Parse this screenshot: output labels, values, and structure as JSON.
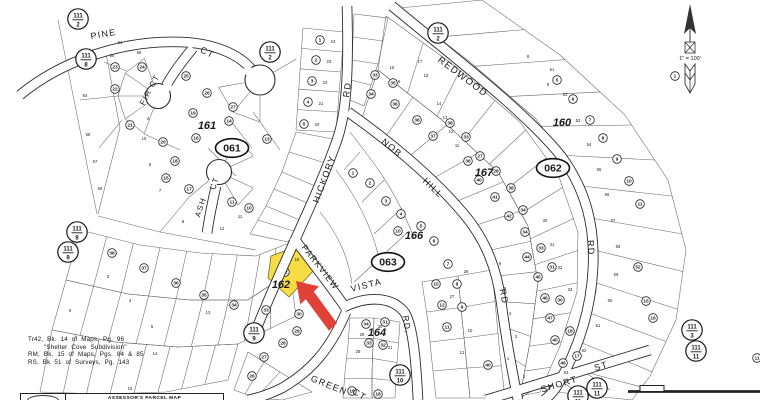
{
  "map": {
    "street_labels": [
      {
        "t": "PINE",
        "x": 104,
        "y": 37,
        "r": -10,
        "s": 9
      },
      {
        "t": "CT",
        "x": 206,
        "y": 55,
        "r": 28,
        "s": 9
      },
      {
        "t": "FIR CT",
        "x": 152,
        "y": 91,
        "r": -62,
        "s": 8
      },
      {
        "t": "ASH",
        "x": 203,
        "y": 208,
        "r": -72,
        "s": 8
      },
      {
        "t": "CT",
        "x": 217,
        "y": 184,
        "r": -72,
        "s": 8
      },
      {
        "t": "HICKORY",
        "x": 327,
        "y": 180,
        "r": -70,
        "s": 9
      },
      {
        "t": "RD",
        "x": 350,
        "y": 90,
        "r": -82,
        "s": 9
      },
      {
        "t": "NOB",
        "x": 390,
        "y": 150,
        "r": 40,
        "s": 9
      },
      {
        "t": "HILL",
        "x": 431,
        "y": 190,
        "r": 44,
        "s": 9
      },
      {
        "t": "RD",
        "x": 501,
        "y": 297,
        "r": 80,
        "s": 9
      },
      {
        "t": "REDWOOD",
        "x": 461,
        "y": 79,
        "r": 37,
        "s": 9.5
      },
      {
        "t": "RD",
        "x": 588,
        "y": 248,
        "r": 86,
        "s": 9
      },
      {
        "t": "PARKVIEW",
        "x": 318,
        "y": 269,
        "r": 52,
        "s": 8.5
      },
      {
        "t": "VISTA",
        "x": 367,
        "y": 288,
        "r": -14,
        "s": 9
      },
      {
        "t": "RD.",
        "x": 404,
        "y": 325,
        "r": 82,
        "s": 8.5
      },
      {
        "t": "GREEN",
        "x": 328,
        "y": 388,
        "r": 22,
        "s": 9
      },
      {
        "t": "CT",
        "x": 358,
        "y": 397,
        "r": 32,
        "s": 9
      },
      {
        "t": "SHORT",
        "x": 560,
        "y": 387,
        "r": -17,
        "s": 9
      },
      {
        "t": "ST",
        "x": 602,
        "y": 369,
        "r": -17,
        "s": 9
      }
    ],
    "block_labels": [
      {
        "t": "161",
        "x": 207,
        "y": 129
      },
      {
        "t": "160",
        "x": 562,
        "y": 126
      },
      {
        "t": "167",
        "x": 484,
        "y": 176
      },
      {
        "t": "166",
        "x": 414,
        "y": 239
      },
      {
        "t": "162",
        "x": 281,
        "y": 288
      },
      {
        "t": "164",
        "x": 377,
        "y": 336
      }
    ],
    "book_ovals": [
      {
        "t": "061",
        "x": 232,
        "y": 148
      },
      {
        "t": "062",
        "x": 553,
        "y": 168
      },
      {
        "t": "063",
        "x": 388,
        "y": 262
      }
    ],
    "ref_circles": [
      {
        "top": "111",
        "bottom": "2",
        "x": 78,
        "y": 19
      },
      {
        "top": "111",
        "bottom": "8",
        "x": 86,
        "y": 59
      },
      {
        "top": "111",
        "bottom": "2",
        "x": 270,
        "y": 52
      },
      {
        "top": "111",
        "bottom": "2",
        "x": 438,
        "y": 33
      },
      {
        "top": "111",
        "bottom": "8",
        "x": 77,
        "y": 232
      },
      {
        "top": "111",
        "bottom": "9",
        "x": 68,
        "y": 252
      },
      {
        "top": "111",
        "bottom": "9",
        "x": 254,
        "y": 333
      },
      {
        "top": "111",
        "bottom": "10",
        "x": 400,
        "y": 375
      },
      {
        "top": "111",
        "bottom": "11",
        "x": 597,
        "y": 388
      },
      {
        "top": "111",
        "bottom": "11",
        "x": 578,
        "y": 396
      },
      {
        "top": "111",
        "bottom": "3",
        "x": 692,
        "y": 330
      },
      {
        "top": "111",
        "bottom": "11",
        "x": 696,
        "y": 351
      }
    ],
    "parcel_circles": [
      [
        "23",
        115,
        67
      ],
      [
        "24",
        142,
        67
      ],
      [
        "22",
        115,
        89
      ],
      [
        "25",
        186,
        76
      ],
      [
        "26",
        207,
        93
      ],
      [
        "27",
        233,
        107
      ],
      [
        "21",
        130,
        125
      ],
      [
        "19",
        193,
        113
      ],
      [
        "14",
        229,
        121
      ],
      [
        "16",
        196,
        138
      ],
      [
        "13",
        267,
        139
      ],
      [
        "20",
        163,
        142
      ],
      [
        "18",
        175,
        161
      ],
      [
        "15",
        166,
        178
      ],
      [
        "17",
        189,
        189
      ],
      [
        "11",
        232,
        202
      ],
      [
        "10",
        249,
        208
      ],
      [
        "1",
        320,
        40
      ],
      [
        "2",
        316,
        60
      ],
      [
        "3",
        312,
        81
      ],
      [
        "4",
        308,
        102
      ],
      [
        "5",
        304,
        124
      ],
      [
        "1",
        353,
        173
      ],
      [
        "2",
        370,
        183
      ],
      [
        "3",
        386,
        201
      ],
      [
        "4",
        401,
        214
      ],
      [
        "5",
        421,
        226
      ],
      [
        "6",
        434,
        241
      ],
      [
        "7",
        448,
        264
      ],
      [
        "8",
        457,
        284
      ],
      [
        "9",
        462,
        307
      ],
      [
        "10",
        398,
        231
      ],
      [
        "33",
        375,
        75
      ],
      [
        "34",
        371,
        94
      ],
      [
        "35",
        393,
        83
      ],
      [
        "36",
        395,
        104
      ],
      [
        "36",
        417,
        120
      ],
      [
        "37",
        433,
        136
      ],
      [
        "38",
        450,
        123
      ],
      [
        "33",
        466,
        137
      ],
      [
        "27",
        480,
        156
      ],
      [
        "36",
        468,
        161
      ],
      [
        "28",
        496,
        171
      ],
      [
        "40",
        479,
        180
      ],
      [
        "38",
        511,
        188
      ],
      [
        "41",
        495,
        197
      ],
      [
        "42",
        509,
        216
      ],
      [
        "34",
        523,
        210
      ],
      [
        "34",
        525,
        232
      ],
      [
        "33",
        541,
        248
      ],
      [
        "44",
        527,
        257
      ],
      [
        "31",
        552,
        267
      ],
      [
        "45",
        538,
        277
      ],
      [
        "46",
        545,
        298
      ],
      [
        "30",
        560,
        300
      ],
      [
        "47",
        550,
        318
      ],
      [
        "18",
        570,
        331
      ],
      [
        "45",
        555,
        340
      ],
      [
        "17",
        577,
        356
      ],
      [
        "46",
        563,
        363
      ],
      [
        "52",
        638,
        267
      ],
      [
        "15",
        646,
        301
      ],
      [
        "16",
        653,
        318
      ],
      [
        "11",
        757,
        358
      ],
      [
        "40",
        488,
        365
      ],
      [
        "1",
        675,
        76
      ],
      [
        "5",
        557,
        80
      ],
      [
        "6",
        573,
        99
      ],
      [
        "7",
        590,
        120
      ],
      [
        "8",
        603,
        138
      ],
      [
        "9",
        617,
        159
      ],
      [
        "10",
        629,
        181
      ],
      [
        "11",
        640,
        204
      ],
      [
        "34",
        366,
        324
      ],
      [
        "31",
        385,
        322
      ],
      [
        "33",
        369,
        343
      ],
      [
        "32",
        383,
        345
      ],
      [
        "15",
        436,
        284
      ],
      [
        "12",
        442,
        305
      ],
      [
        "11",
        447,
        327
      ],
      [
        "33",
        266,
        310
      ],
      [
        "30",
        299,
        314
      ],
      [
        "29",
        297,
        331
      ],
      [
        "28",
        283,
        343
      ],
      [
        "27",
        264,
        357
      ],
      [
        "26",
        252,
        376
      ],
      [
        "38",
        112,
        253
      ],
      [
        "37",
        144,
        268
      ],
      [
        "36",
        176,
        283
      ],
      [
        "35",
        204,
        295
      ],
      [
        "34",
        234,
        305
      ],
      [
        "19",
        352,
        391
      ],
      [
        "18",
        378,
        394
      ]
    ],
    "lot_numbers": [
      [
        "24",
        333,
        43
      ],
      [
        "23",
        329,
        63
      ],
      [
        "22",
        325,
        84
      ],
      [
        "21",
        321,
        105
      ],
      [
        "20",
        317,
        126
      ],
      [
        "65",
        112,
        57
      ],
      [
        "66",
        139,
        54
      ],
      [
        "64",
        85,
        97
      ],
      [
        "61",
        120,
        44
      ],
      [
        "57",
        95,
        163
      ],
      [
        "58",
        88,
        136
      ],
      [
        "56",
        100,
        190
      ],
      [
        "17",
        420,
        63
      ],
      [
        "18",
        426,
        77
      ],
      [
        "15",
        392,
        69
      ],
      [
        "16",
        398,
        83
      ],
      [
        "14",
        439,
        105
      ],
      [
        "13",
        445,
        119
      ],
      [
        "12",
        451,
        133
      ],
      [
        "11",
        457,
        147
      ],
      [
        "53",
        578,
        122
      ],
      [
        "52",
        565,
        96
      ],
      [
        "51",
        552,
        71
      ],
      [
        "54",
        589,
        146
      ],
      [
        "55",
        599,
        171
      ],
      [
        "56",
        607,
        196
      ],
      [
        "57",
        613,
        222
      ],
      [
        "58",
        618,
        248
      ],
      [
        "59",
        616,
        276
      ],
      [
        "60",
        610,
        302
      ],
      [
        "61",
        598,
        327
      ],
      [
        "62",
        584,
        352
      ],
      [
        "63",
        566,
        374
      ],
      [
        "29",
        362,
        336
      ],
      [
        "30",
        380,
        328
      ],
      [
        "28",
        358,
        353
      ],
      [
        "31",
        390,
        349
      ],
      [
        "27",
        452,
        298
      ],
      [
        "26",
        466,
        273
      ],
      [
        "10",
        470,
        332
      ],
      [
        "12",
        462,
        354
      ],
      [
        "15",
        297,
        261
      ],
      [
        "3",
        108,
        278
      ],
      [
        "4",
        130,
        302
      ],
      [
        "5",
        152,
        328
      ],
      [
        "9",
        70,
        312
      ],
      [
        "13",
        208,
        314
      ],
      [
        "14",
        155,
        355
      ],
      [
        "16",
        130,
        390
      ],
      [
        "7",
        160,
        192
      ],
      [
        "8",
        183,
        223
      ],
      [
        "6",
        150,
        166
      ],
      [
        "2",
        148,
        120
      ],
      [
        "10",
        144,
        140
      ],
      [
        "11",
        240,
        218
      ],
      [
        "12",
        222,
        230
      ],
      [
        "8",
        528,
        58
      ],
      [
        "9",
        548,
        86
      ],
      [
        "1",
        508,
        360
      ],
      [
        "2",
        524,
        378
      ],
      [
        "3",
        516,
        338
      ],
      [
        "4",
        510,
        315
      ],
      [
        "5",
        505,
        290
      ],
      [
        "6",
        500,
        265
      ],
      [
        "30",
        545,
        222
      ],
      [
        "31",
        552,
        246
      ],
      [
        "32",
        560,
        269
      ],
      [
        "33",
        570,
        291
      ]
    ],
    "highlight": {
      "lot_circle": "32",
      "lot": "15",
      "fill": "#f6dd45",
      "cx": 285,
      "cy": 272
    },
    "arrow_color": "#e04237",
    "north": {
      "scale_text": "1\" = 100'"
    },
    "footer": {
      "lines": [
        "Tr42, Bk. 14 of Maps, Pg. 96",
        "\"Shelter Cove Subdivision\"",
        "RM, Bk. 15 of Maps, Pgs. 84 & 85",
        "RS, Bk 51 of Surveys, Pg. 143"
      ]
    },
    "stamp": {
      "title": "ASSESSOR'S PARCEL MAP"
    }
  }
}
